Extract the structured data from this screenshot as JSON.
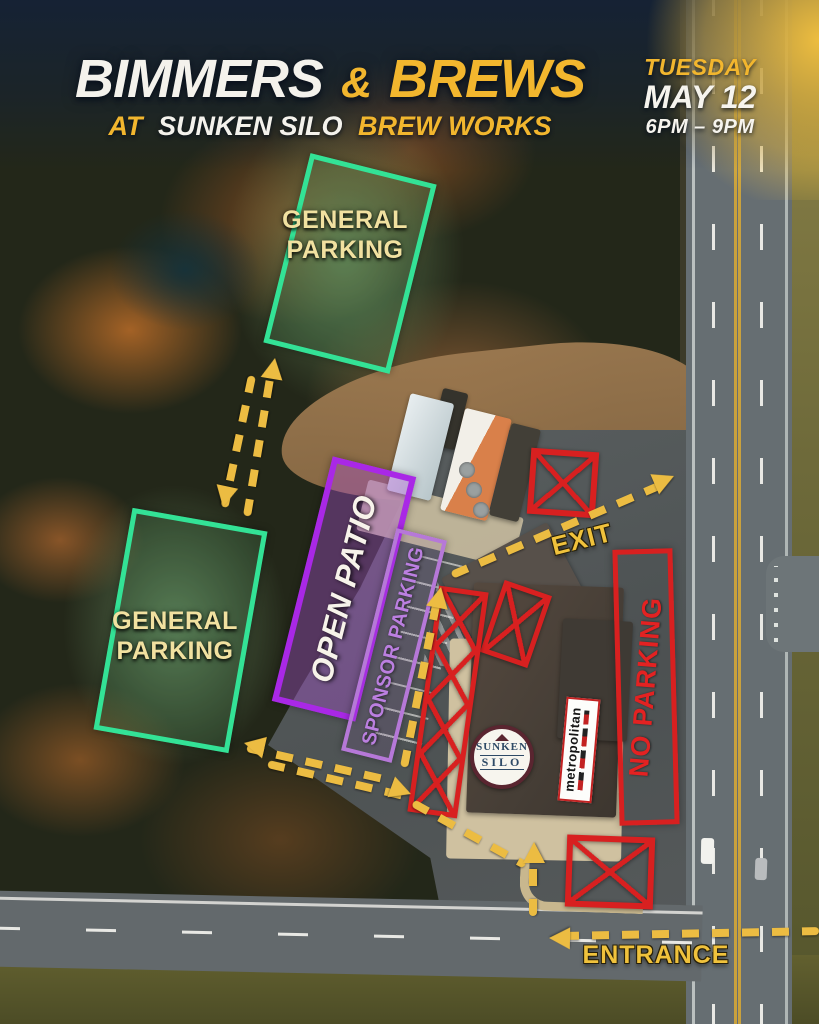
{
  "header": {
    "title": {
      "word1": "BIMMERS",
      "amp": "&",
      "word2": "BREWS"
    },
    "subtitle": {
      "prefix": "AT",
      "venue": "SUNKEN SILO",
      "suffix": "BREW WORKS"
    },
    "event": {
      "day": "TUESDAY",
      "date": "MAY 12",
      "time": "6PM – 9PM"
    }
  },
  "zones": {
    "general_parking_top": "GENERAL PARKING",
    "general_parking_west": "GENERAL PARKING",
    "open_patio": "OPEN PATIO",
    "sponsor_parking": "SPONSOR PARKING",
    "no_parking": "NO PARKING"
  },
  "routes": {
    "exit": "EXIT",
    "entrance": "ENTRANCE"
  },
  "logos": {
    "sunken_silo": {
      "line1": "SUNKEN",
      "line2": "SILO"
    },
    "metropolitan": "metropolitan"
  },
  "colors": {
    "accent_yellow": "#f2b62e",
    "arrow_yellow": "#ecbc42",
    "zone_green": "#33e296",
    "zone_purple": "#a928e6",
    "zone_light_purple": "#b678d8",
    "zone_red": "#d82020",
    "label_cream": "#f1e1a0"
  }
}
